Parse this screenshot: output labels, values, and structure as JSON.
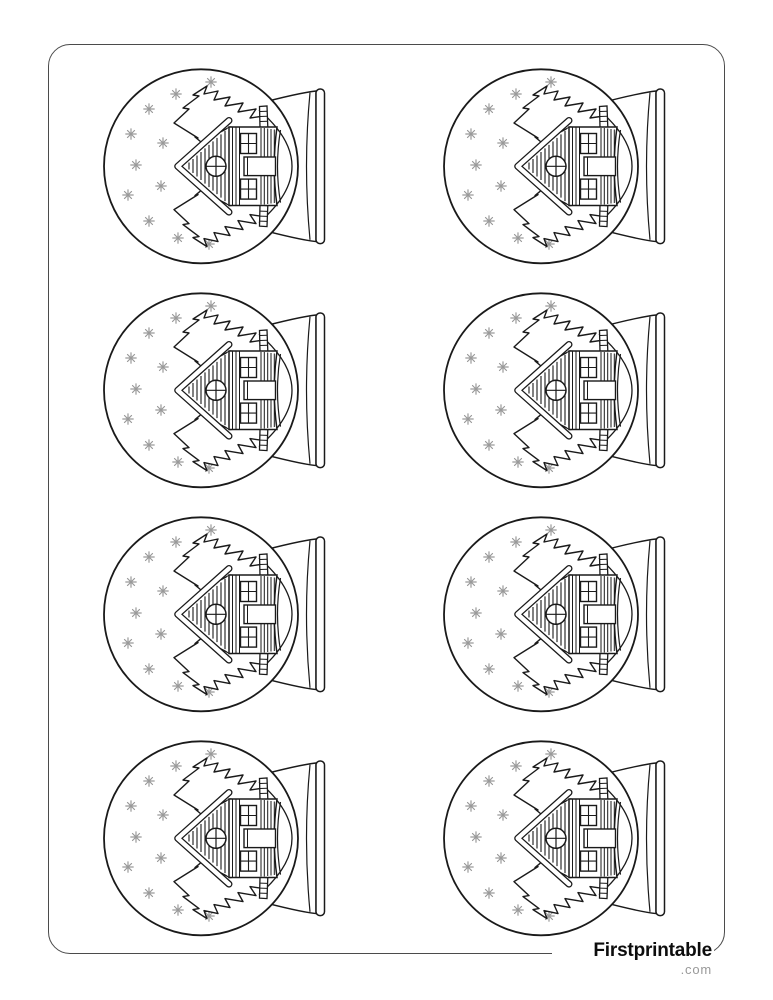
{
  "page": {
    "kind": "printable coloring page",
    "background_color": "#ffffff",
    "border_color": "#4b4b4b"
  },
  "artwork": {
    "motif": "snow globe with log cabin, pine trees and snowflakes",
    "orientation": "rotated 90 degrees, globe base on right",
    "outline_color": "#1a1a1a",
    "snowflake_color": "#9a9a9a",
    "grid": {
      "rows": 4,
      "columns": 2,
      "count": 8
    },
    "snowflakes_per_globe": 11
  },
  "footer": {
    "brand": "Firstprintable",
    "domain": ".com",
    "brand_color": "#0d0d0d",
    "domain_color": "#999999"
  }
}
